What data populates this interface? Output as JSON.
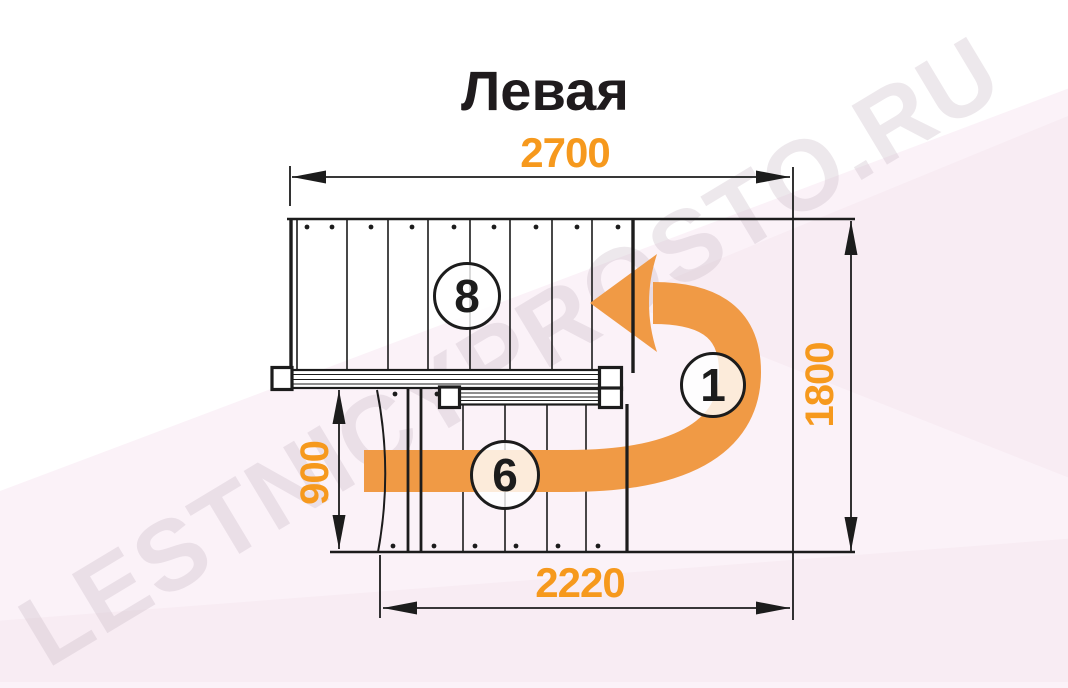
{
  "title": "Левая",
  "watermark_text": "LESTNICYPROSTO.RU",
  "dimensions": {
    "total_length_mm": "2700",
    "total_width_mm": "1800",
    "lower_flight_width_mm": "900",
    "lower_flight_length_mm": "2220"
  },
  "step_counts": {
    "upper_flight": "8",
    "landing_turn": "1",
    "lower_flight": "6"
  },
  "colors": {
    "dimension_text": "#f6991d",
    "direction_arrow": "#f09a45",
    "drawing_line": "#1c1c1c",
    "background": "#fbf2f8",
    "watermark": "#c5b2bf"
  }
}
